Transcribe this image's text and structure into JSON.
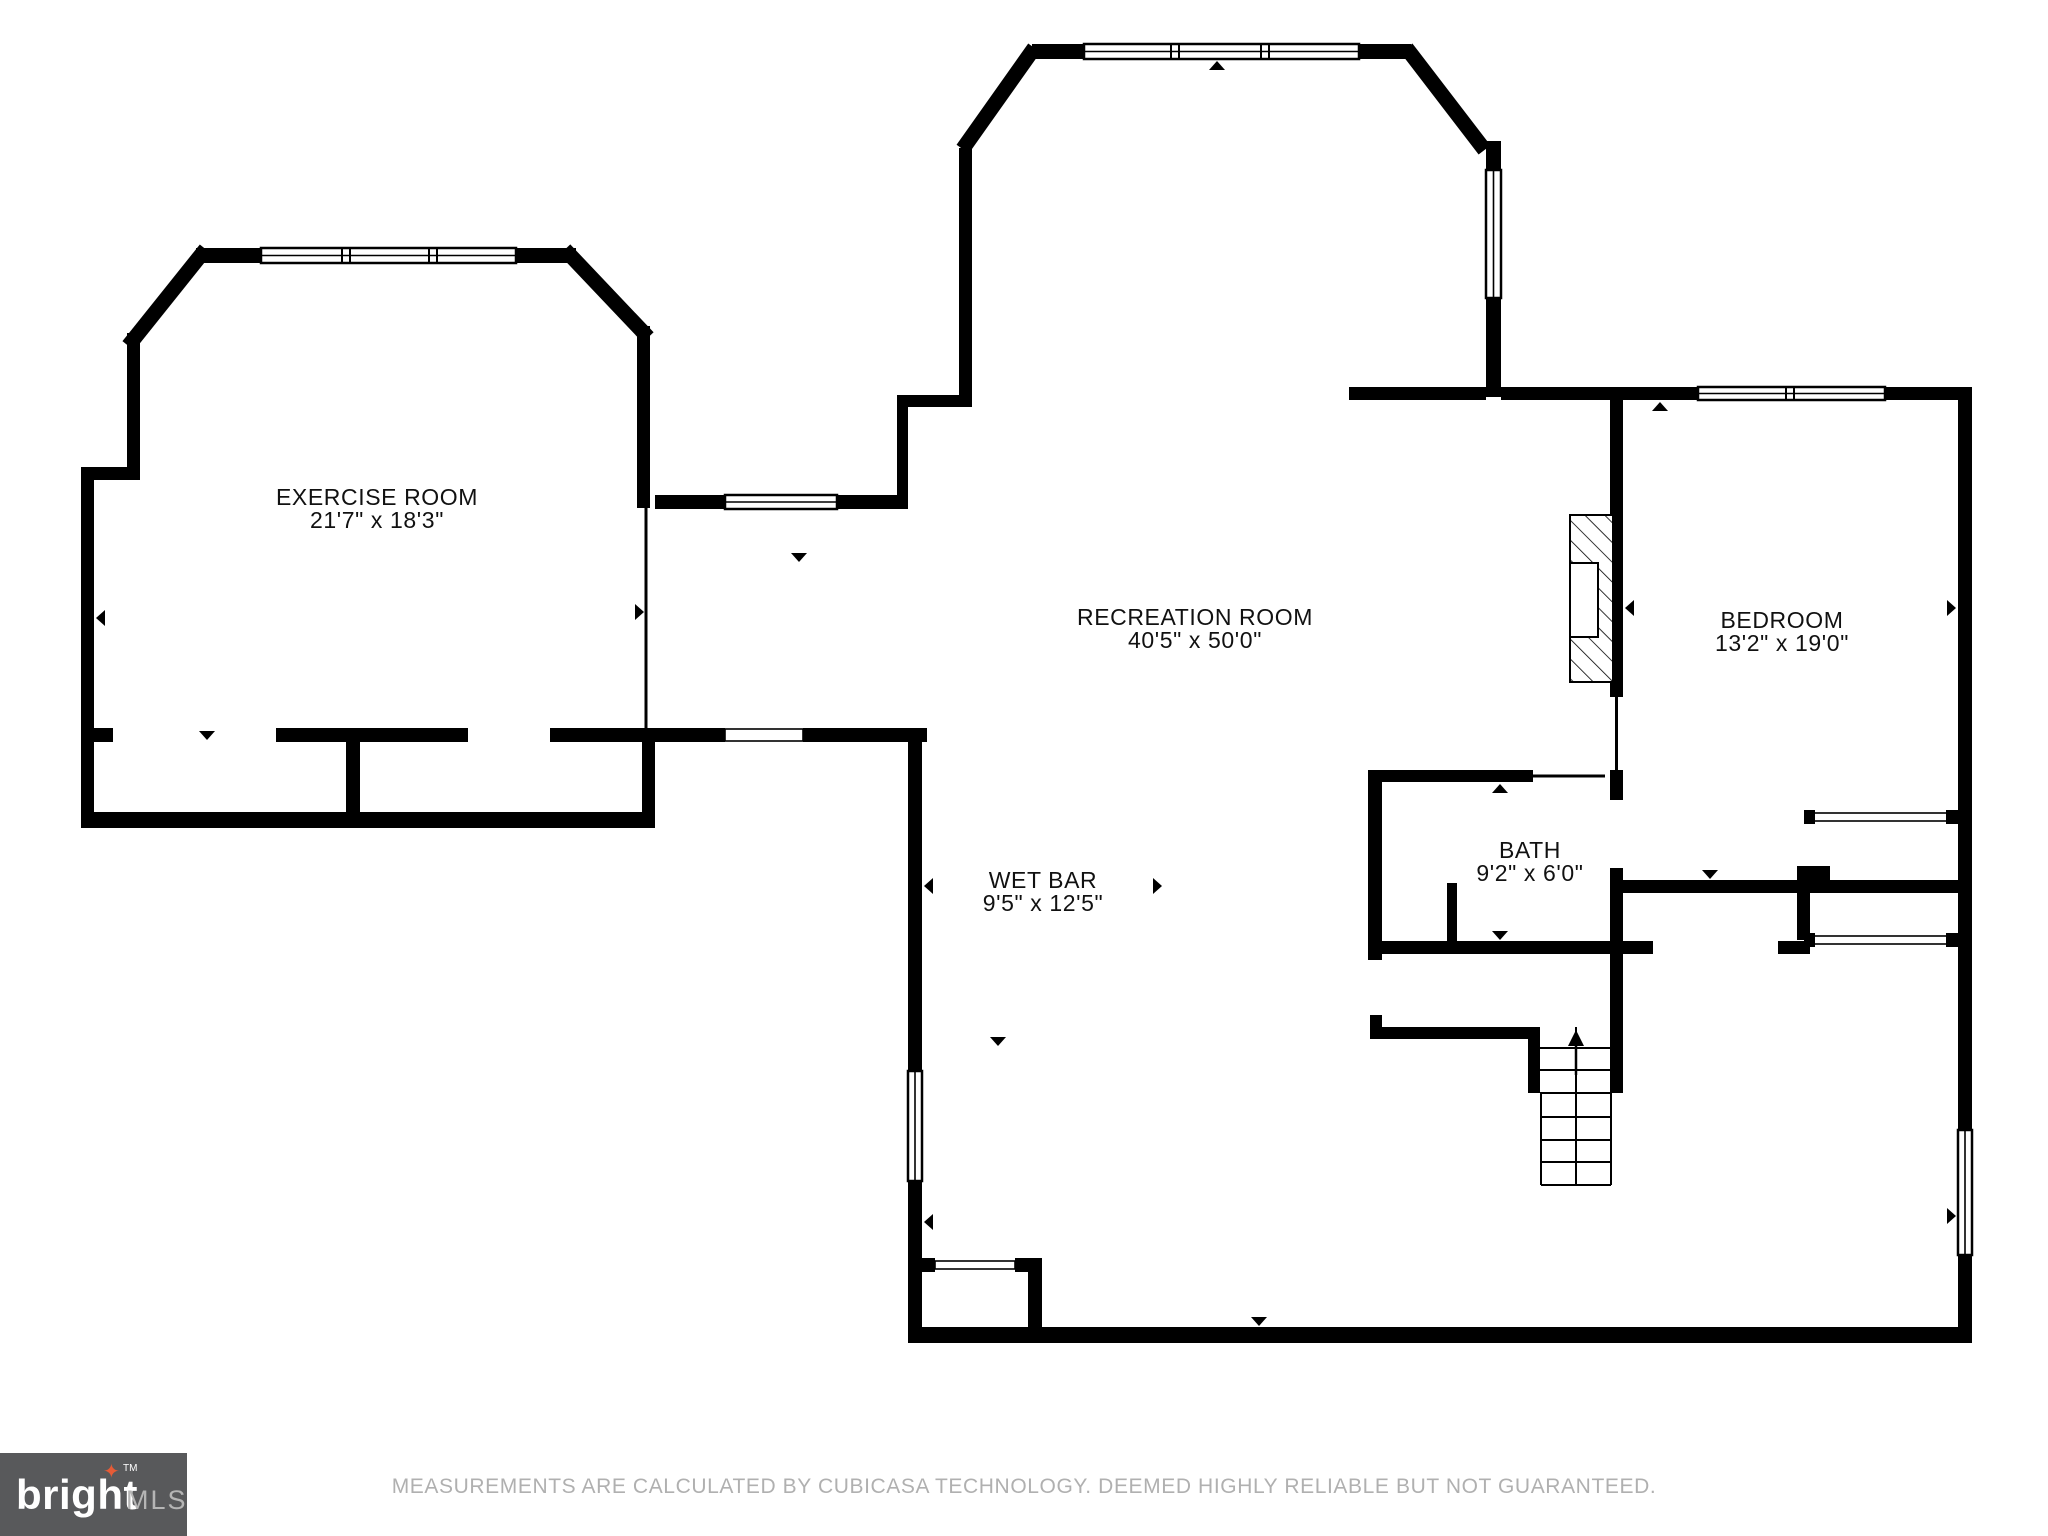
{
  "floorplan": {
    "wall_color": "#000000",
    "rooms": [
      {
        "id": "exercise",
        "name": "EXERCISE ROOM",
        "dims": "21'7\" x 18'3\""
      },
      {
        "id": "recreation",
        "name": "RECREATION ROOM",
        "dims": "40'5\" x 50'0\""
      },
      {
        "id": "wetbar",
        "name": "WET BAR",
        "dims": "9'5\" x 12'5\""
      },
      {
        "id": "bath",
        "name": "BATH",
        "dims": "9'2\" x 6'0\""
      },
      {
        "id": "bedroom",
        "name": "BEDROOM",
        "dims": "13'2\" x 19'0\""
      }
    ]
  },
  "footer": {
    "logo": {
      "brand": "bright",
      "star_icon": "✦",
      "tm": "TM",
      "suffix": "MLS",
      "bg_color": "#58595b",
      "star_color": "#e65b36"
    },
    "disclaimer": "MEASUREMENTS ARE CALCULATED BY CUBICASA TECHNOLOGY. DEEMED HIGHLY RELIABLE BUT NOT GUARANTEED."
  }
}
